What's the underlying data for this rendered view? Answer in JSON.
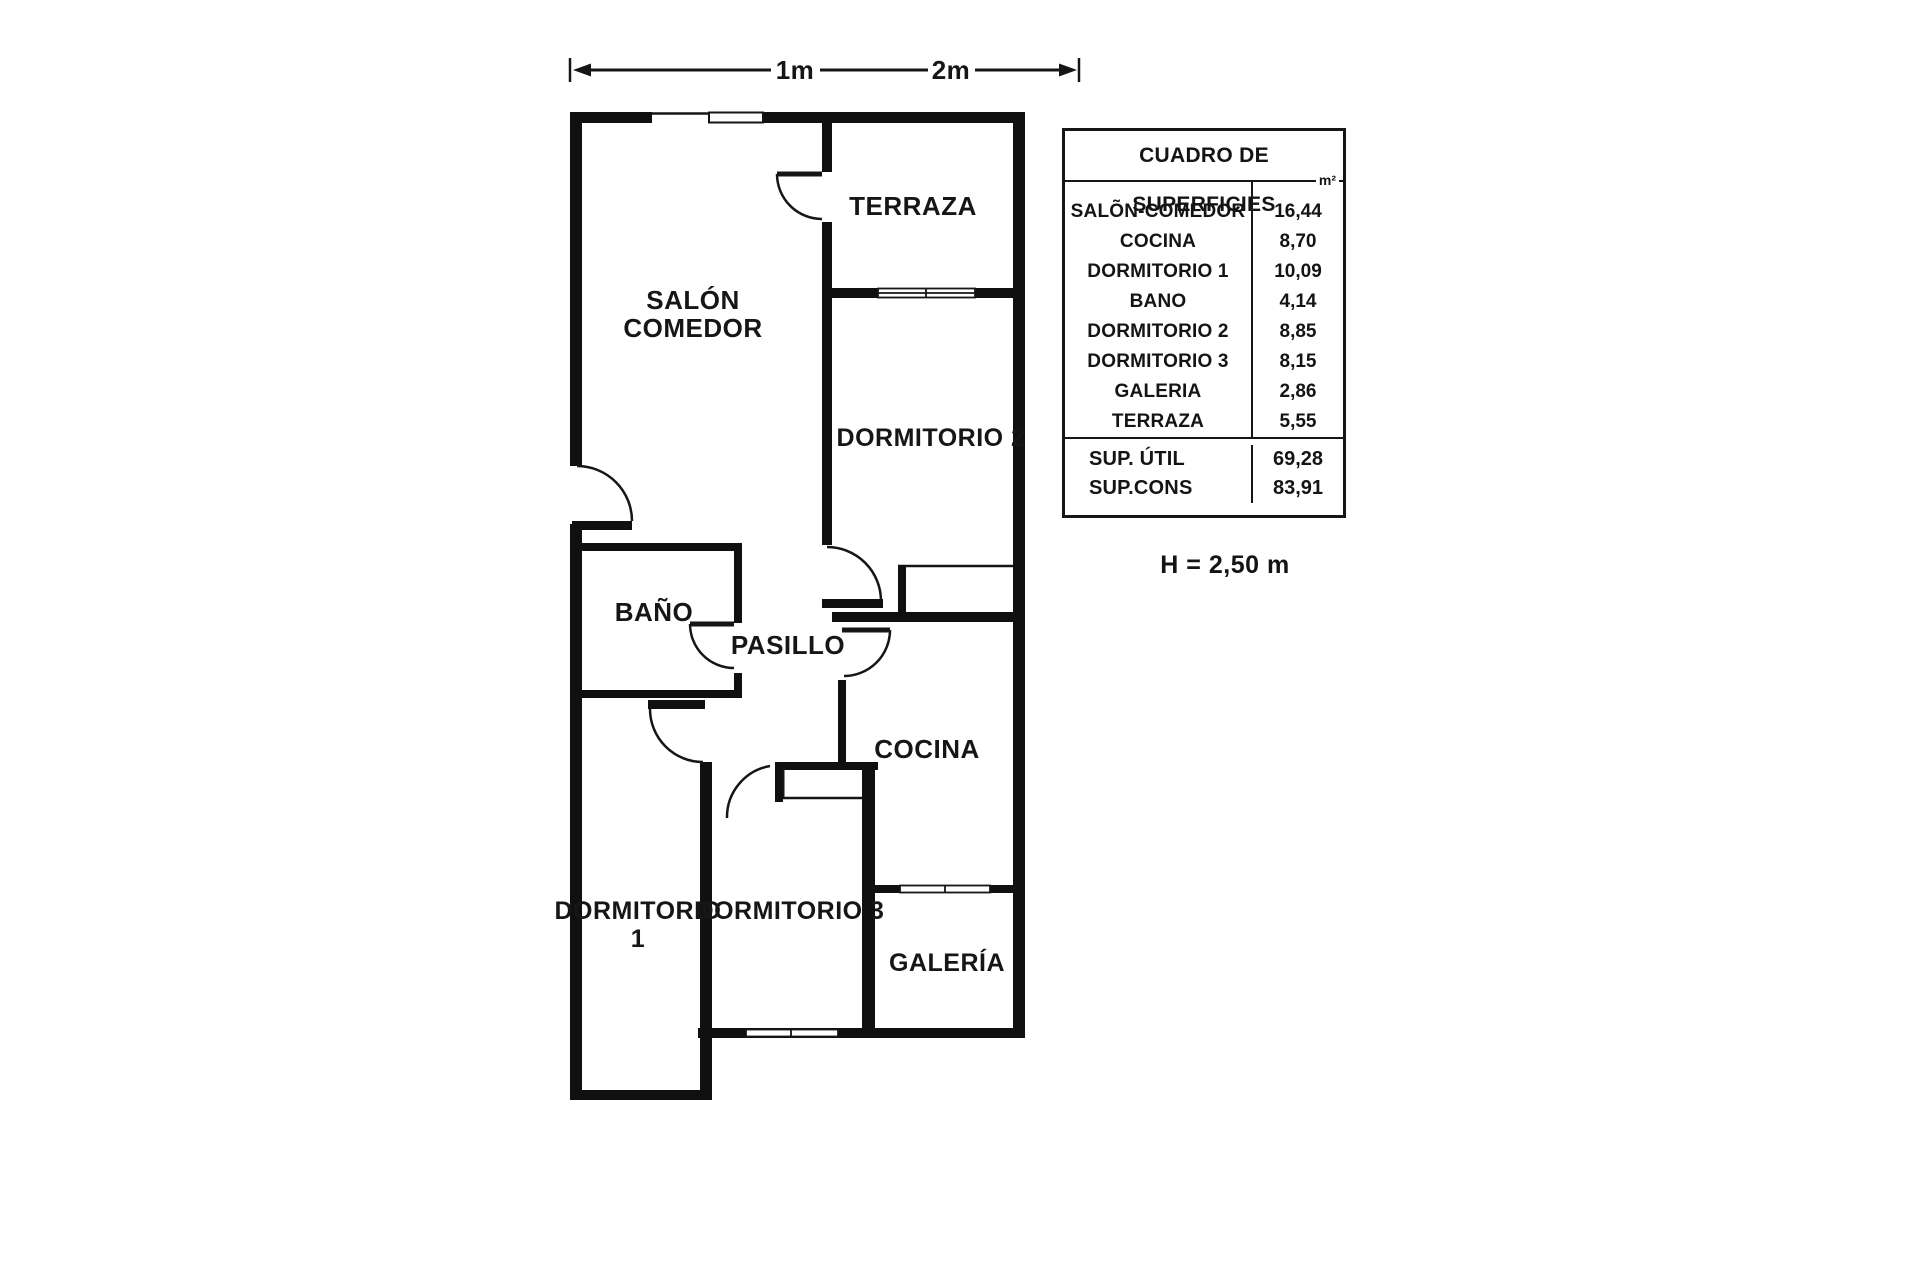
{
  "scale_bar": {
    "label_1": "1m",
    "label_2": "2m"
  },
  "rooms": {
    "terraza": "TERRAZA",
    "salon_line1": "SALÓN",
    "salon_line2": "COMEDOR",
    "dormitorio2": "DORMITORIO 2",
    "bano": "BAÑO",
    "pasillo": "PASILLO",
    "cocina": "COCINA",
    "dormitorio1_line1": "DORMITORIO",
    "dormitorio1_line2": "1",
    "dormitorio3": "DORMITORIO 3",
    "galeria": "GALERÍA"
  },
  "table": {
    "title": "CUADRO DE SUPERFICIES",
    "unit_header": "m²",
    "rows": [
      {
        "label": "SALÕN-COMEDOR",
        "value": "16,44"
      },
      {
        "label": "COCINA",
        "value": "8,70"
      },
      {
        "label": "DORMITORIO 1",
        "value": "10,09"
      },
      {
        "label": "BANO",
        "value": "4,14"
      },
      {
        "label": "DORMITORIO 2",
        "value": "8,85"
      },
      {
        "label": "DORMITORIO 3",
        "value": "8,15"
      },
      {
        "label": "GALERIA",
        "value": "2,86"
      },
      {
        "label": "TERRAZA",
        "value": "5,55"
      }
    ],
    "totals": [
      {
        "label": "SUP. ÚTIL",
        "value": "69,28"
      },
      {
        "label": "SUP.CONS",
        "value": "83,91"
      }
    ]
  },
  "height_note": "H = 2,50 m"
}
